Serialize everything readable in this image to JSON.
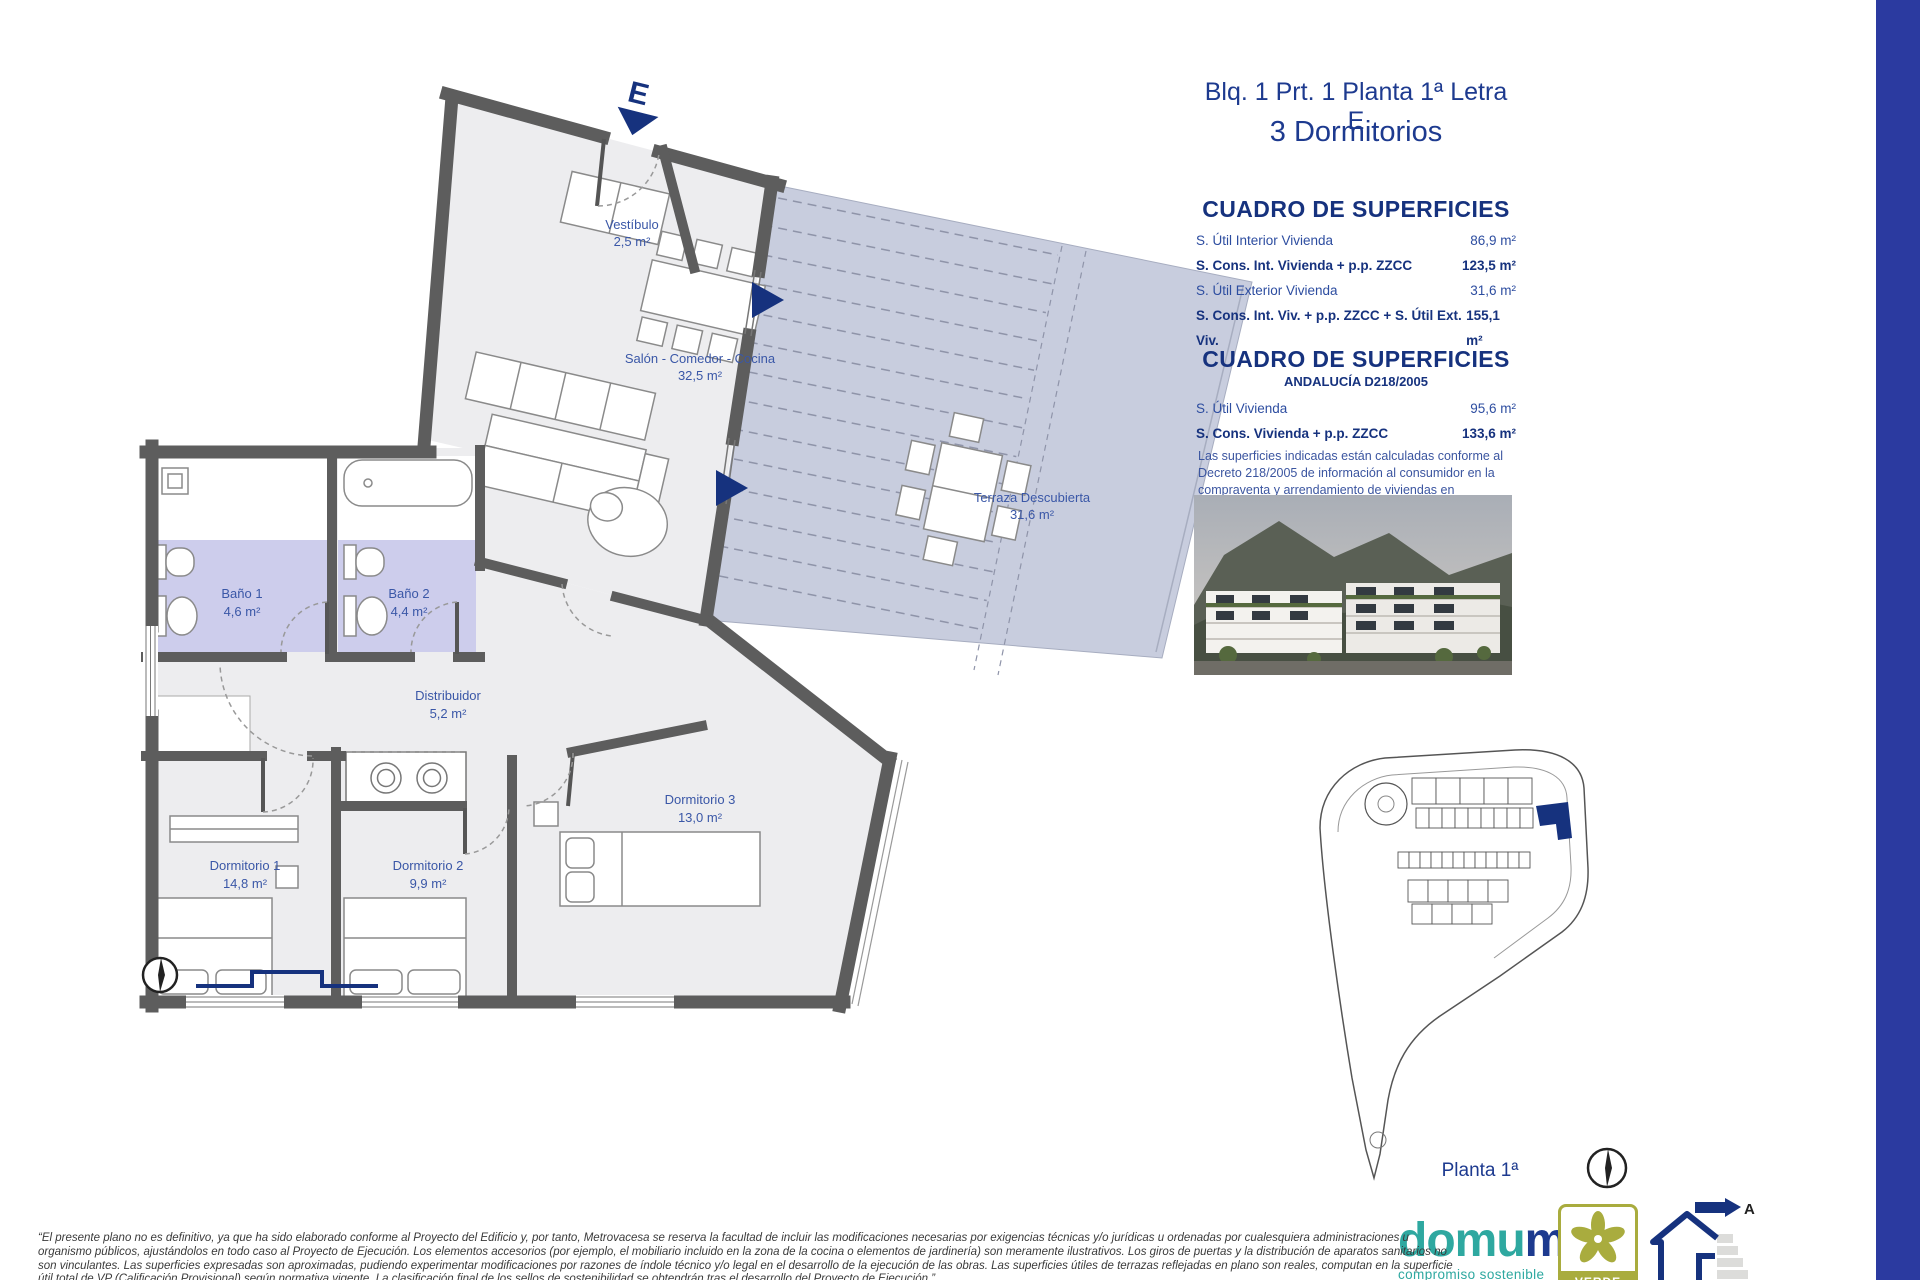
{
  "document": {
    "sheet_title": "Blq. 1 Prt. 1 Planta 1ª Letra E",
    "sheet_subtitle": "3 Dormitorios"
  },
  "surfaces_table_1": {
    "heading": "CUADRO DE SUPERFICIES",
    "rows": [
      {
        "label": "S. Útil Interior Vivienda",
        "value": "86,9 m²"
      },
      {
        "label": "S. Cons. Int. Vivienda + p.p. ZZCC",
        "value": "123,5 m²"
      },
      {
        "label": "S. Útil Exterior Vivienda",
        "value": "31,6 m²"
      },
      {
        "label": "S. Cons. Int. Viv. + p.p. ZZCC + S. Útil Ext. Viv.",
        "value": "155,1 m²"
      }
    ]
  },
  "surfaces_table_2": {
    "heading": "CUADRO DE SUPERFICIES",
    "subheading": "ANDALUCÍA D218/2005",
    "rows": [
      {
        "label": "S. Útil Vivienda",
        "value": "95,6 m²"
      },
      {
        "label": "S. Cons. Vivienda + p.p. ZZCC",
        "value": "133,6 m²"
      }
    ],
    "note": "Las superficies indicadas están calculadas conforme al Decreto 218/2005 de información al consumidor en la compraventa y arrendamiento de viviendas en Andalucía."
  },
  "floor_plan": {
    "entrance_marker": "E",
    "rooms": [
      {
        "name": "Vestíbulo",
        "area": "2,5 m²"
      },
      {
        "name": "Salón - Comedor - Cocina",
        "area": "32,5 m²"
      },
      {
        "name": "Baño 1",
        "area": "4,6 m²"
      },
      {
        "name": "Baño 2",
        "area": "4,4 m²"
      },
      {
        "name": "Distribuidor",
        "area": "5,2 m²"
      },
      {
        "name": "Dormitorio 1",
        "area": "14,8 m²"
      },
      {
        "name": "Dormitorio 2",
        "area": "9,9 m²"
      },
      {
        "name": "Dormitorio 3",
        "area": "13,0 m²"
      },
      {
        "name": "Terraza Descubierta",
        "area": "31,6 m²"
      }
    ]
  },
  "site_plan": {
    "floor_label": "Planta 1ª"
  },
  "branding": {
    "logo_part_1": "domu",
    "logo_part_2": "m",
    "tagline": "compromiso sostenible",
    "badge_label": "VERDE",
    "energy_letter": "A"
  },
  "disclaimer": {
    "lines": [
      "“El presente plano no es definitivo, ya que ha sido elaborado conforme al Proyecto del Edificio y, por tanto, Metrovacesa se reserva la facultad de incluir las modificaciones necesarias por exigencias técnicas y/o jurídicas u ordenadas por cualesquiera administraciones u",
      "organismo públicos, ajustándolos en todo caso al Proyecto de Ejecución. Los elementos accesorios (por ejemplo, el mobiliario incluido en la zona de la cocina o elementos de jardinería) son meramente ilustrativos. Los giros de puertas y la distribución de aparatos sanitarios no",
      "son vinculantes. Las superficies expresadas son aproximadas, pudiendo experimentar modificaciones por razones de índole técnico y/o legal en el desarrollo de la ejecución de las obras. Las superficies útiles de terrazas reflejadas en plano son reales, computan en la superficie",
      "útil total de VP (Calificación Provisional) según normativa vigente. La clasificación final de los sellos de sostenibilidad se obtendrán tras el desarrollo del Proyecto de Ejecución.”"
    ]
  },
  "colors": {
    "accent_navy": "#16327e",
    "heading_blue": "#1d3a8f",
    "room_label_blue": "#3a57a7",
    "stripe_blue": "#2b3aa0",
    "terrace_fill": "#c8cdde",
    "bathroom_fill": "#cdcdec",
    "wall_gray": "#5d5d5d",
    "domum_teal": "#2ea8a0",
    "verde_olive": "#a9ac3e"
  }
}
